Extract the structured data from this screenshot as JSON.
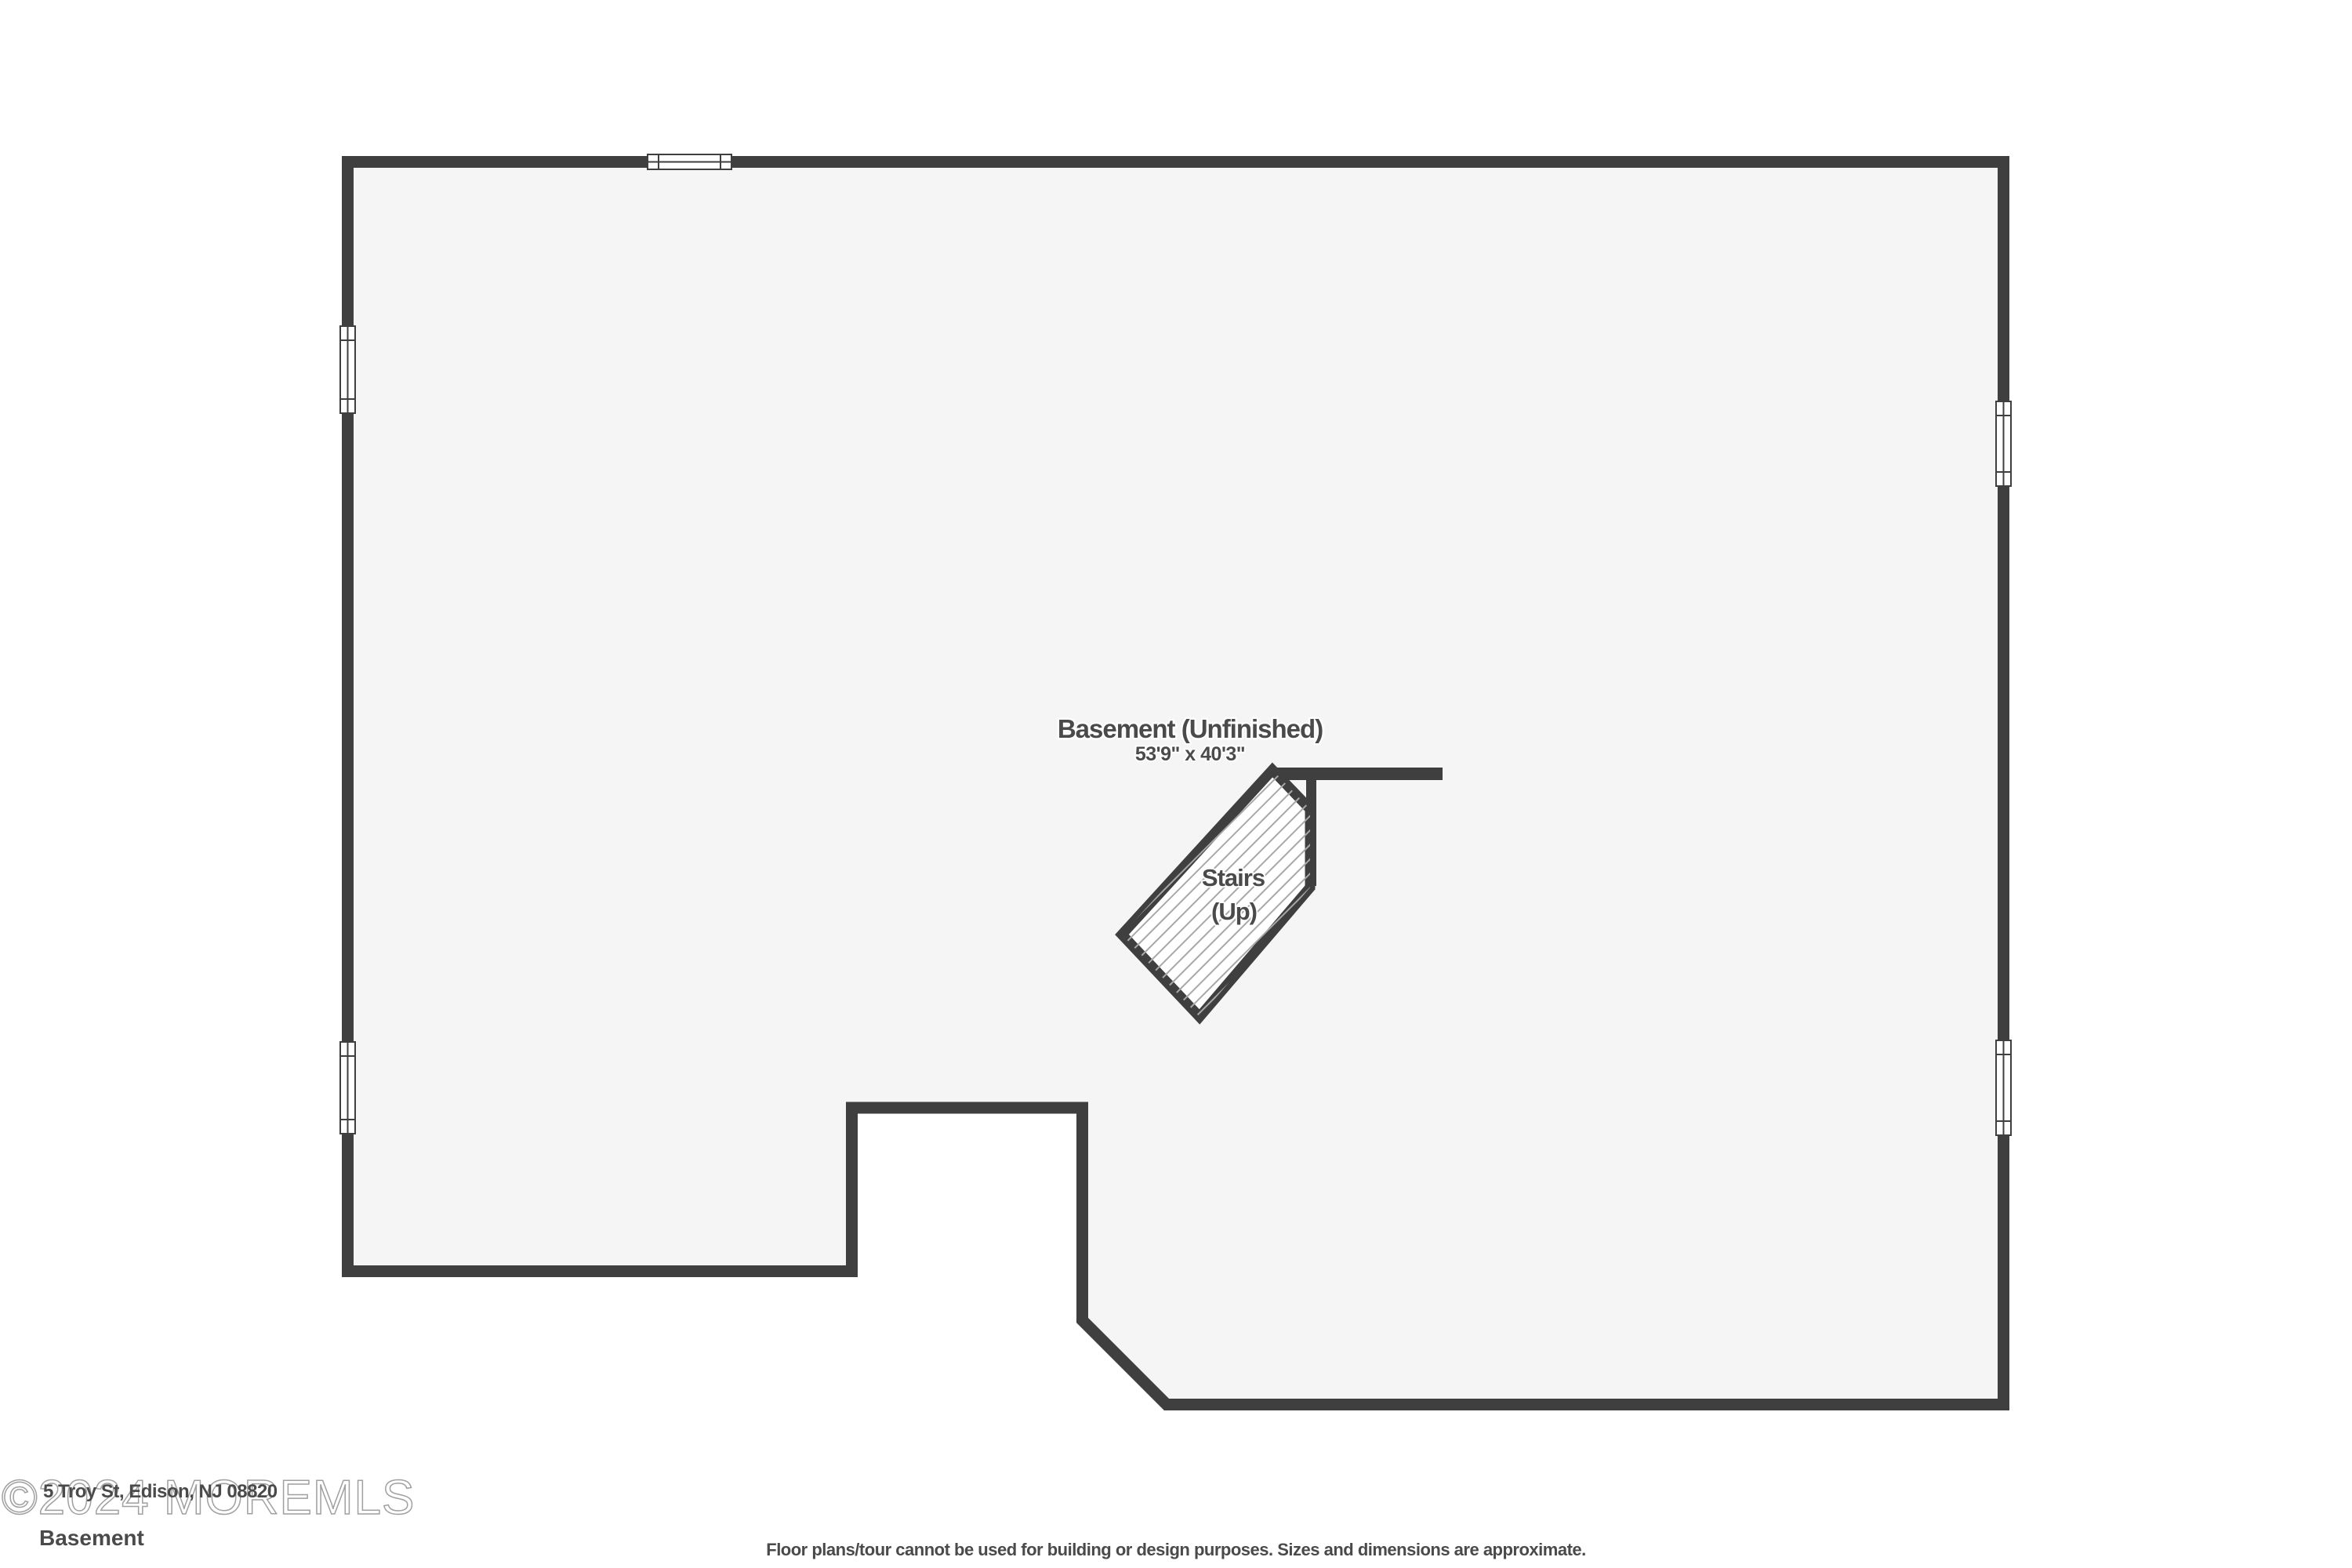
{
  "floor_plan": {
    "room": {
      "label": "Basement (Unfinished)",
      "dimensions": "53'9\" x 40'3\""
    },
    "stairs": {
      "label": "Stairs",
      "direction": "(Up)"
    },
    "colors": {
      "wall": "#3f3f3f",
      "floor": "#f5f5f5",
      "label": "#4a4a4a",
      "watermark": "#a0a0a0",
      "hatch": "#a8a8a8"
    }
  },
  "footer": {
    "watermark": "©2024 MOREMLS",
    "address": "5 Troy St, Edison, NJ 08820",
    "floor_name": "Basement",
    "disclaimer": "Floor plans/tour cannot be used for building or design purposes. Sizes and dimensions are approximate."
  }
}
